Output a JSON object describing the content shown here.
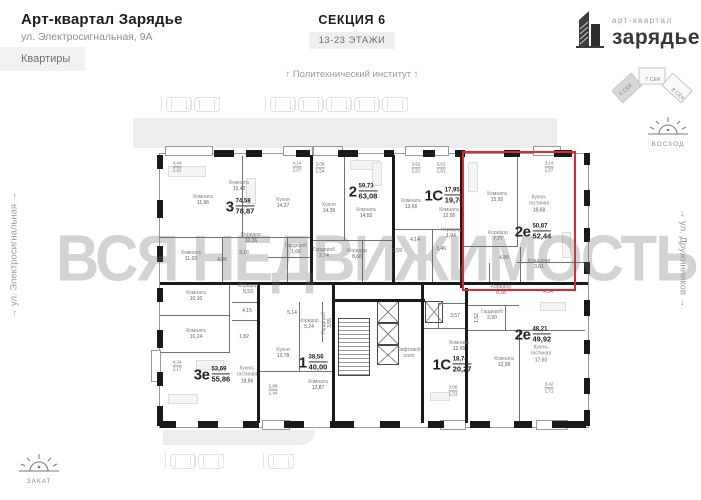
{
  "header": {
    "title": "Арт-квартал Зарядье",
    "address": "ул. Электросигнальная, 9А",
    "apartments_button": "Квартиры",
    "section_title": "СЕКЦИЯ 6",
    "floors_badge": "13-23 ЭТАЖИ"
  },
  "logo": {
    "top": "арт-квартал",
    "bottom": "зарядье"
  },
  "section_selector": {
    "sections": [
      "6 СЕК",
      "7 СЕК",
      "8 СЕК"
    ],
    "active": "6 СЕК"
  },
  "surroundings": {
    "top_street": "↑ Политехнический институт ↑",
    "left_street": "→ ул. Электросигнальная →",
    "right_street": "→ ул. Дружинников →",
    "sunrise": "ВОСХОД",
    "sunset": "ЗАКАТ"
  },
  "watermark": "ВСЯ НЕДВИЖИМОСТЬ",
  "colors": {
    "accent": "#e8242a",
    "wall": "#1a1a1a",
    "road": "#ededed",
    "watermark_gray": "#d8d8d8"
  },
  "plan": {
    "core_label": "Лифтовой холл",
    "core_x": 409,
    "core_y": 353,
    "apartments": [
      {
        "type": "3",
        "area_top": "74,58",
        "area_bottom": "78,87",
        "x": 240,
        "y": 207,
        "highlighted": false,
        "rooms": [
          {
            "name": "Комната",
            "area": "11,96",
            "x": 203,
            "y": 200
          },
          {
            "name": "Комната",
            "area": "15,42",
            "x": 239,
            "y": 186
          },
          {
            "name": "Кухня",
            "area": "14,27",
            "x": 283,
            "y": 203
          },
          {
            "name": "Комната",
            "area": "11,69",
            "x": 191,
            "y": 256
          },
          {
            "name": "Коридор",
            "area": "10,36",
            "x": 251,
            "y": 238
          },
          {
            "name": "Гардероб",
            "area": "1,66",
            "x": 296,
            "y": 249
          },
          {
            "area": "4,06",
            "x": 222,
            "y": 260
          },
          {
            "area": "3,16",
            "x": 244,
            "y": 253
          }
        ]
      },
      {
        "type": "2",
        "area_top": "59,73",
        "area_bottom": "63,08",
        "x": 363,
        "y": 192,
        "highlighted": false,
        "rooms": [
          {
            "name": "Кухня",
            "area": "14,39",
            "x": 329,
            "y": 208
          },
          {
            "name": "Комната",
            "area": "14,55",
            "x": 366,
            "y": 213
          },
          {
            "name": "Комната",
            "area": "13,66",
            "x": 411,
            "y": 204
          },
          {
            "name": "Гардероб",
            "area": "2,74",
            "x": 324,
            "y": 253
          },
          {
            "name": "Коридор",
            "area": "8,66",
            "x": 357,
            "y": 254
          },
          {
            "area": "1,59",
            "x": 397,
            "y": 251
          },
          {
            "area": "4,14",
            "x": 415,
            "y": 240
          }
        ]
      },
      {
        "type": "1С",
        "area_top": "17,95",
        "area_bottom": "19,76",
        "x": 444,
        "y": 196,
        "highlighted": false,
        "rooms": [
          {
            "name": "Комната",
            "area": "12,55",
            "x": 449,
            "y": 213
          },
          {
            "name": "Коридор",
            "area": "1,94",
            "x": 451,
            "y": 233
          },
          {
            "area": "3,46",
            "x": 441,
            "y": 249
          }
        ]
      },
      {
        "type": "2е",
        "area_top": "50,87",
        "area_bottom": "52,44",
        "x": 533,
        "y": 232,
        "highlighted": true,
        "rooms": [
          {
            "name": "Комната",
            "area": "15,92",
            "x": 497,
            "y": 197
          },
          {
            "name": "Кухня-гостиная",
            "area": "18,68",
            "x": 539,
            "y": 204,
            "wrap": true
          },
          {
            "name": "Коридор",
            "area": "7,77",
            "x": 498,
            "y": 236
          },
          {
            "area": "4,89",
            "x": 504,
            "y": 258
          },
          {
            "name": "Кладовая",
            "area": "3,61",
            "x": 539,
            "y": 264
          }
        ]
      },
      {
        "type": "2е",
        "area_top": "48,21",
        "area_bottom": "49,92",
        "x": 533,
        "y": 335,
        "highlighted": false,
        "rooms": [
          {
            "name": "Коридор",
            "area": "8,38",
            "x": 501,
            "y": 290
          },
          {
            "area": "4,54",
            "x": 548,
            "y": 292
          },
          {
            "name": "Гардероб",
            "area": "2,90",
            "x": 492,
            "y": 315
          },
          {
            "area": "1,52",
            "x": 477,
            "y": 318,
            "vertical": true
          },
          {
            "name": "Комната",
            "area": "13,98",
            "x": 504,
            "y": 362
          },
          {
            "name": "Кухня-гостиная",
            "area": "17,60",
            "x": 541,
            "y": 354,
            "wrap": true
          }
        ]
      },
      {
        "type": "1С",
        "area_top": "18,74",
        "area_bottom": "20,27",
        "x": 452,
        "y": 365,
        "highlighted": false,
        "rooms": [
          {
            "area": "3,57",
            "x": 455,
            "y": 316
          },
          {
            "name": "Комната",
            "area": "12,65",
            "x": 459,
            "y": 346
          }
        ]
      },
      {
        "type": "1",
        "area_top": "38,56",
        "area_bottom": "40,00",
        "x": 313,
        "y": 363,
        "highlighted": false,
        "rooms": [
          {
            "name": "Коридор",
            "area": "5,24",
            "x": 309,
            "y": 324
          },
          {
            "name": "Гардероб",
            "area": "3,55",
            "x": 327,
            "y": 323,
            "vertical": true
          },
          {
            "area": "5,14",
            "x": 292,
            "y": 313
          },
          {
            "name": "Кухня",
            "area": "12,78",
            "x": 283,
            "y": 353
          },
          {
            "name": "Комната",
            "area": "12,87",
            "x": 318,
            "y": 385
          }
        ]
      },
      {
        "type": "3е",
        "area_top": "53,69",
        "area_bottom": "55,86",
        "x": 212,
        "y": 375,
        "highlighted": false,
        "rooms": [
          {
            "name": "Комната",
            "area": "10,10",
            "x": 196,
            "y": 296
          },
          {
            "name": "Комната",
            "area": "10,24",
            "x": 196,
            "y": 334
          },
          {
            "name": "Коридор",
            "area": "8,53",
            "x": 248,
            "y": 289
          },
          {
            "area": "4,15",
            "x": 247,
            "y": 311
          },
          {
            "area": "1,82",
            "x": 244,
            "y": 337
          },
          {
            "name": "Кухня-гостиная",
            "area": "18,86",
            "x": 247,
            "y": 375,
            "wrap": true
          }
        ]
      }
    ],
    "balconies": [
      {
        "a": "4,44",
        "b": "2,22",
        "x": 177,
        "y": 167
      },
      {
        "a": "4,14",
        "b": "2,07",
        "x": 297,
        "y": 167
      },
      {
        "a": "3,08",
        "b": "1,54",
        "x": 320,
        "y": 168
      },
      {
        "a": "3,62",
        "b": "1,81",
        "x": 416,
        "y": 168
      },
      {
        "a": "3,62",
        "b": "1,81",
        "x": 441,
        "y": 168
      },
      {
        "a": "3,14",
        "b": "1,57",
        "x": 549,
        "y": 167
      },
      {
        "a": "4,34",
        "b": "2,17",
        "x": 177,
        "y": 366
      },
      {
        "a": "2,88",
        "b": "1,44",
        "x": 273,
        "y": 390
      },
      {
        "a": "3,06",
        "b": "1,53",
        "x": 453,
        "y": 391
      },
      {
        "a": "3,42",
        "b": "1,71",
        "x": 549,
        "y": 388
      }
    ]
  }
}
